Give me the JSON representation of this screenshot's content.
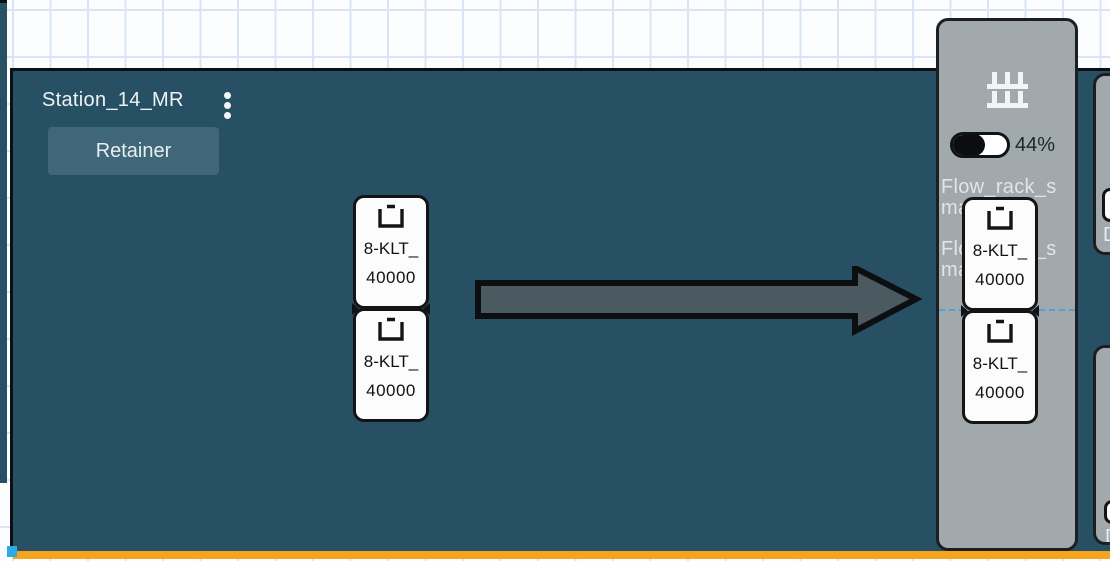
{
  "station": {
    "title": "Station_14_MR",
    "retainer_button": "Retainer"
  },
  "flow_rack": {
    "fill_percent": "44%",
    "labels": [
      "Flow_rack_sma",
      "Flow_rack_sma"
    ]
  },
  "containers": {
    "middle": [
      {
        "line1": "8-KLT_",
        "line2": "40000"
      },
      {
        "line1": "8-KLT_",
        "line2": "40000"
      }
    ],
    "rack": [
      {
        "line1": "8-KLT_",
        "line2": "40000"
      },
      {
        "line1": "8-KLT_",
        "line2": "40000"
      }
    ]
  },
  "edge_panels": [
    {
      "label": "D"
    },
    {
      "label": "D"
    }
  ],
  "icons": {
    "station_menu": "kebab-menu-icon",
    "rack": "flow-rack-icon",
    "container": "bin-icon",
    "flow": "arrow-right"
  },
  "colors": {
    "station_bg": "#285064",
    "panel_bg": "#a1a9ac",
    "accent_orange": "#f6a41f",
    "handle_blue": "#2ea9e2",
    "dashed_guide": "#54a0d6",
    "arrow_fill": "#4b5a60"
  }
}
